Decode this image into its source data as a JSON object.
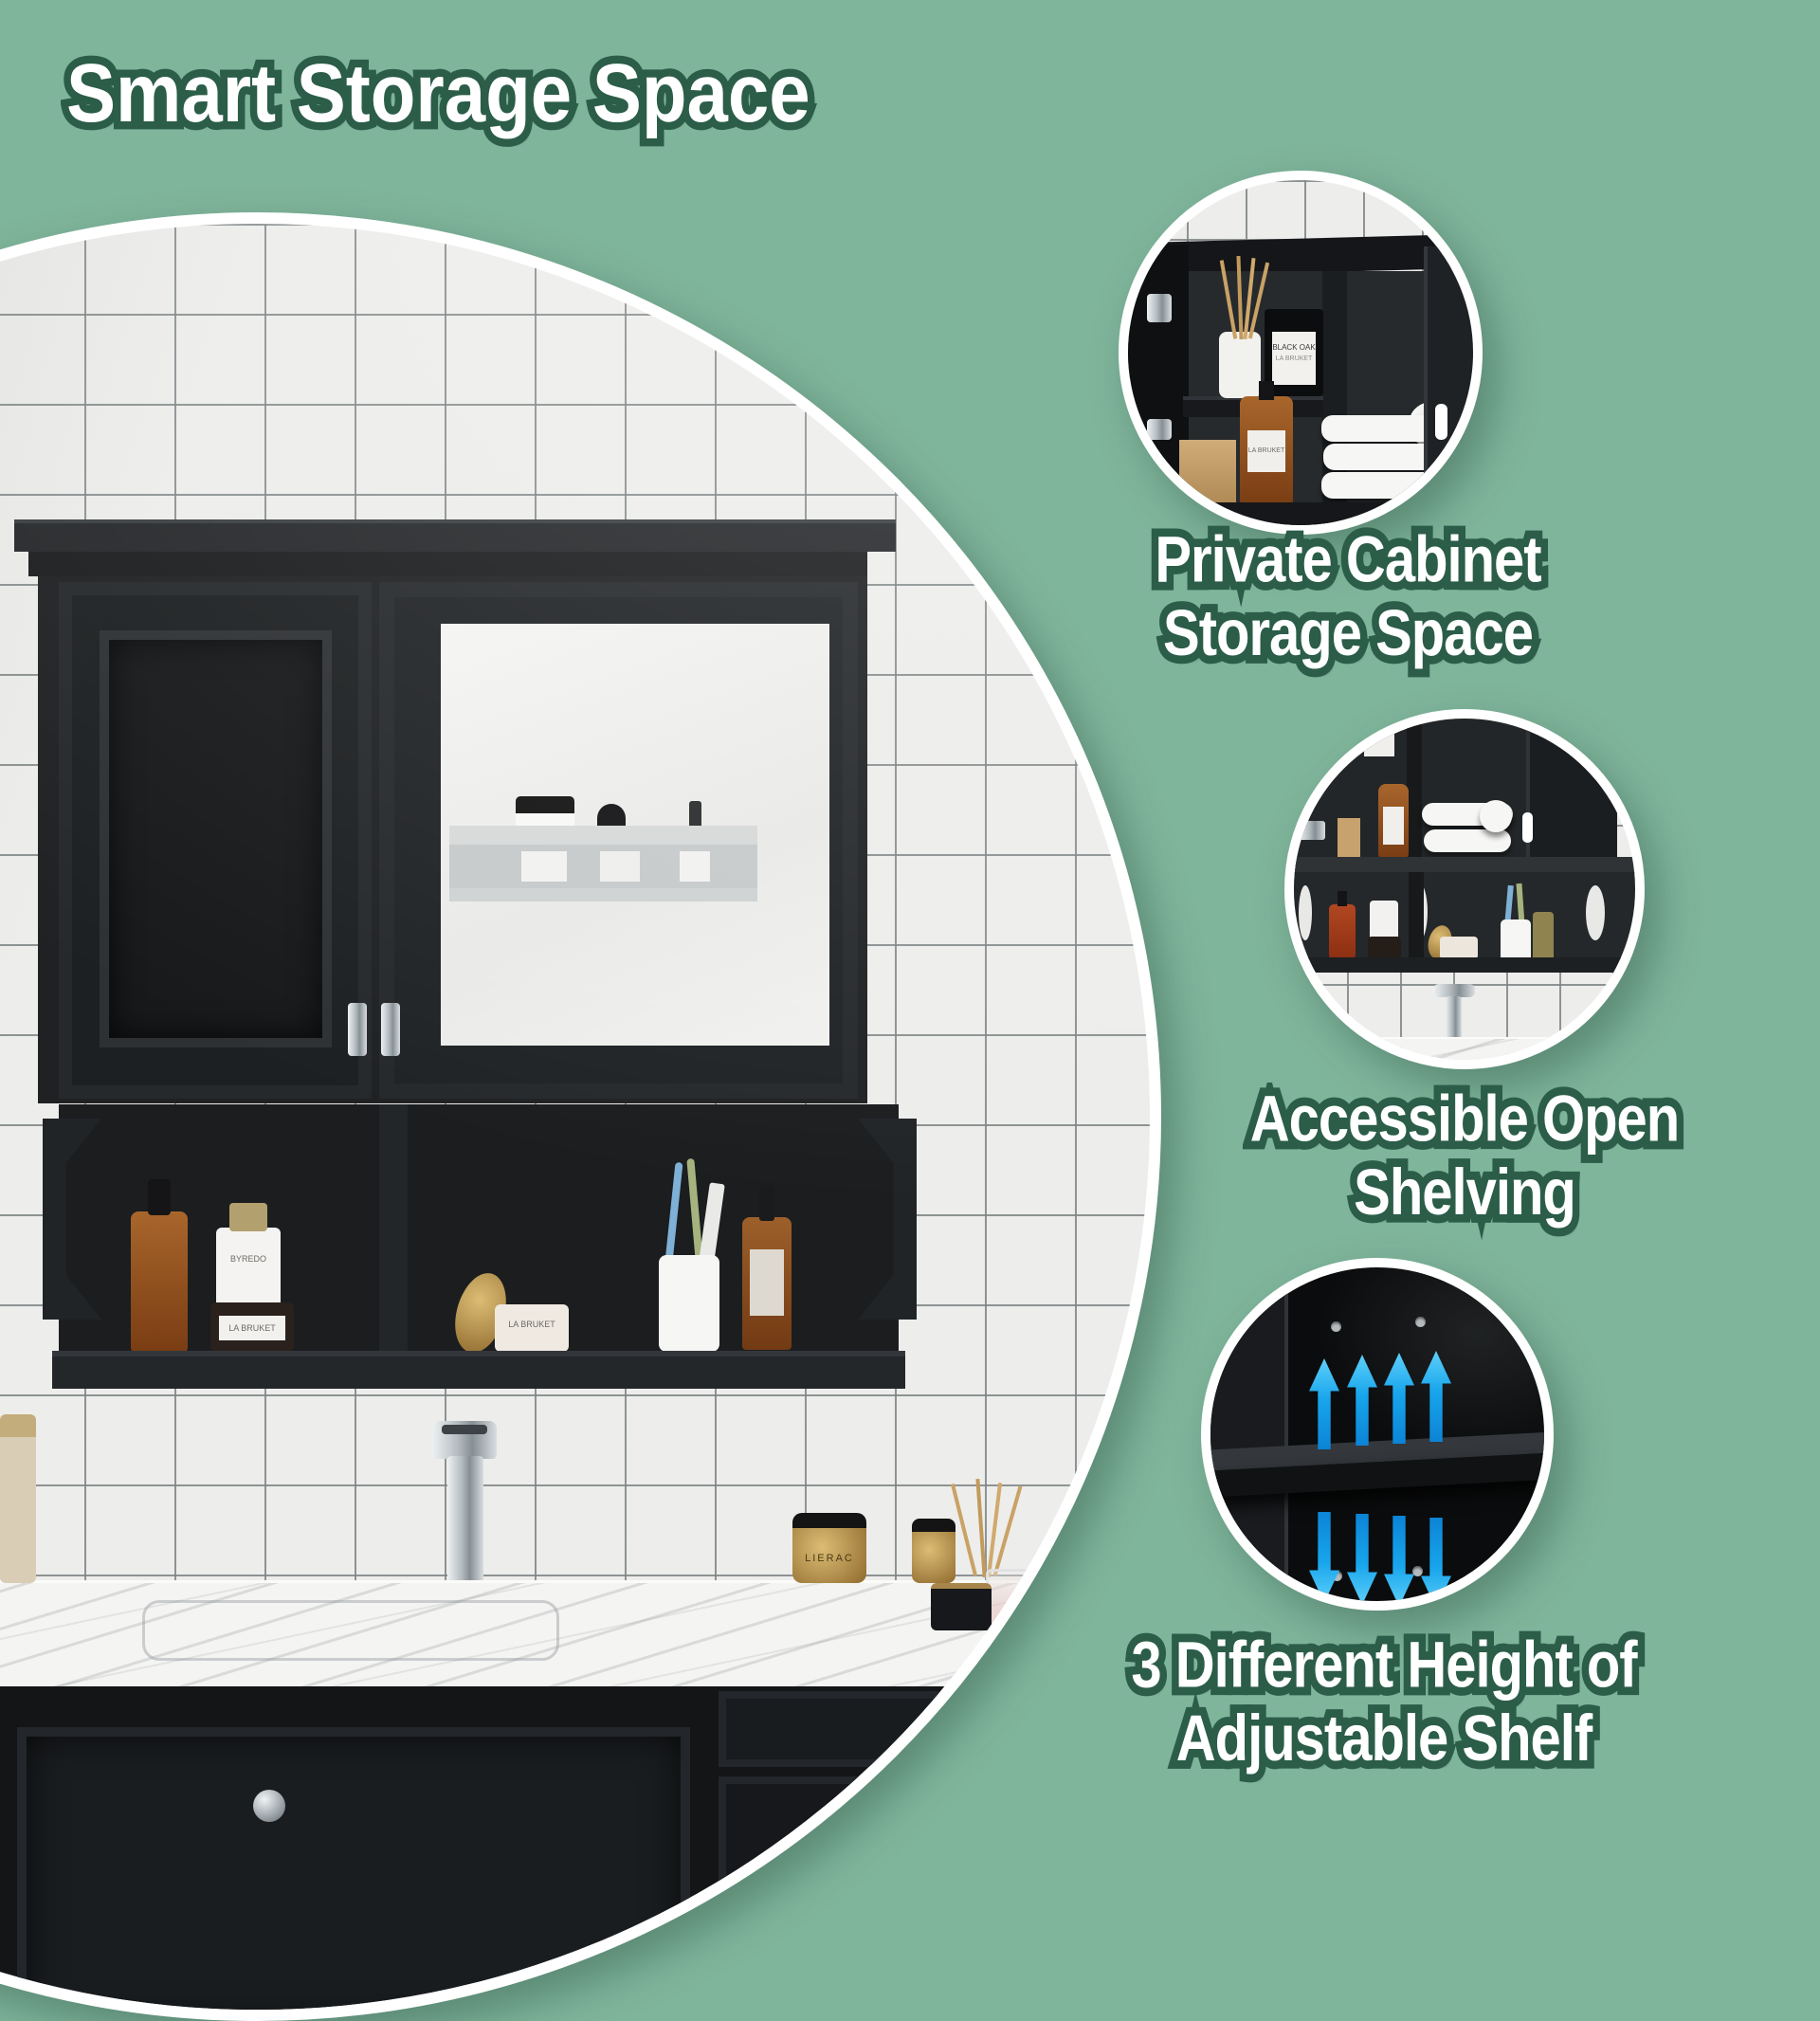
{
  "canvas": {
    "background": "#7fb59b",
    "text_fill": "#ffffff",
    "text_outline": "#2b5d49",
    "arrow_blue": "#18a5ec",
    "cabinet_black": "#1e2022",
    "tile_white": "#ededeb",
    "marble_white": "#f4f4f2"
  },
  "title": "Smart Storage Space",
  "features": [
    {
      "id": "private-cabinet-storage",
      "caption_line1": "Private Cabinet",
      "caption_line2": "Storage Space"
    },
    {
      "id": "accessible-open-shelving",
      "caption_line1": "Accessible Open",
      "caption_line2": "Shelving"
    },
    {
      "id": "adjustable-shelf",
      "caption_line1": "3 Different Height of",
      "caption_line2": "Adjustable Shelf"
    }
  ],
  "photo_labels": {
    "byredo": "BYREDO",
    "la_bruket": "LA BRUKET",
    "black_oak": "BLACK OAK",
    "lierac": "LIERAC"
  }
}
